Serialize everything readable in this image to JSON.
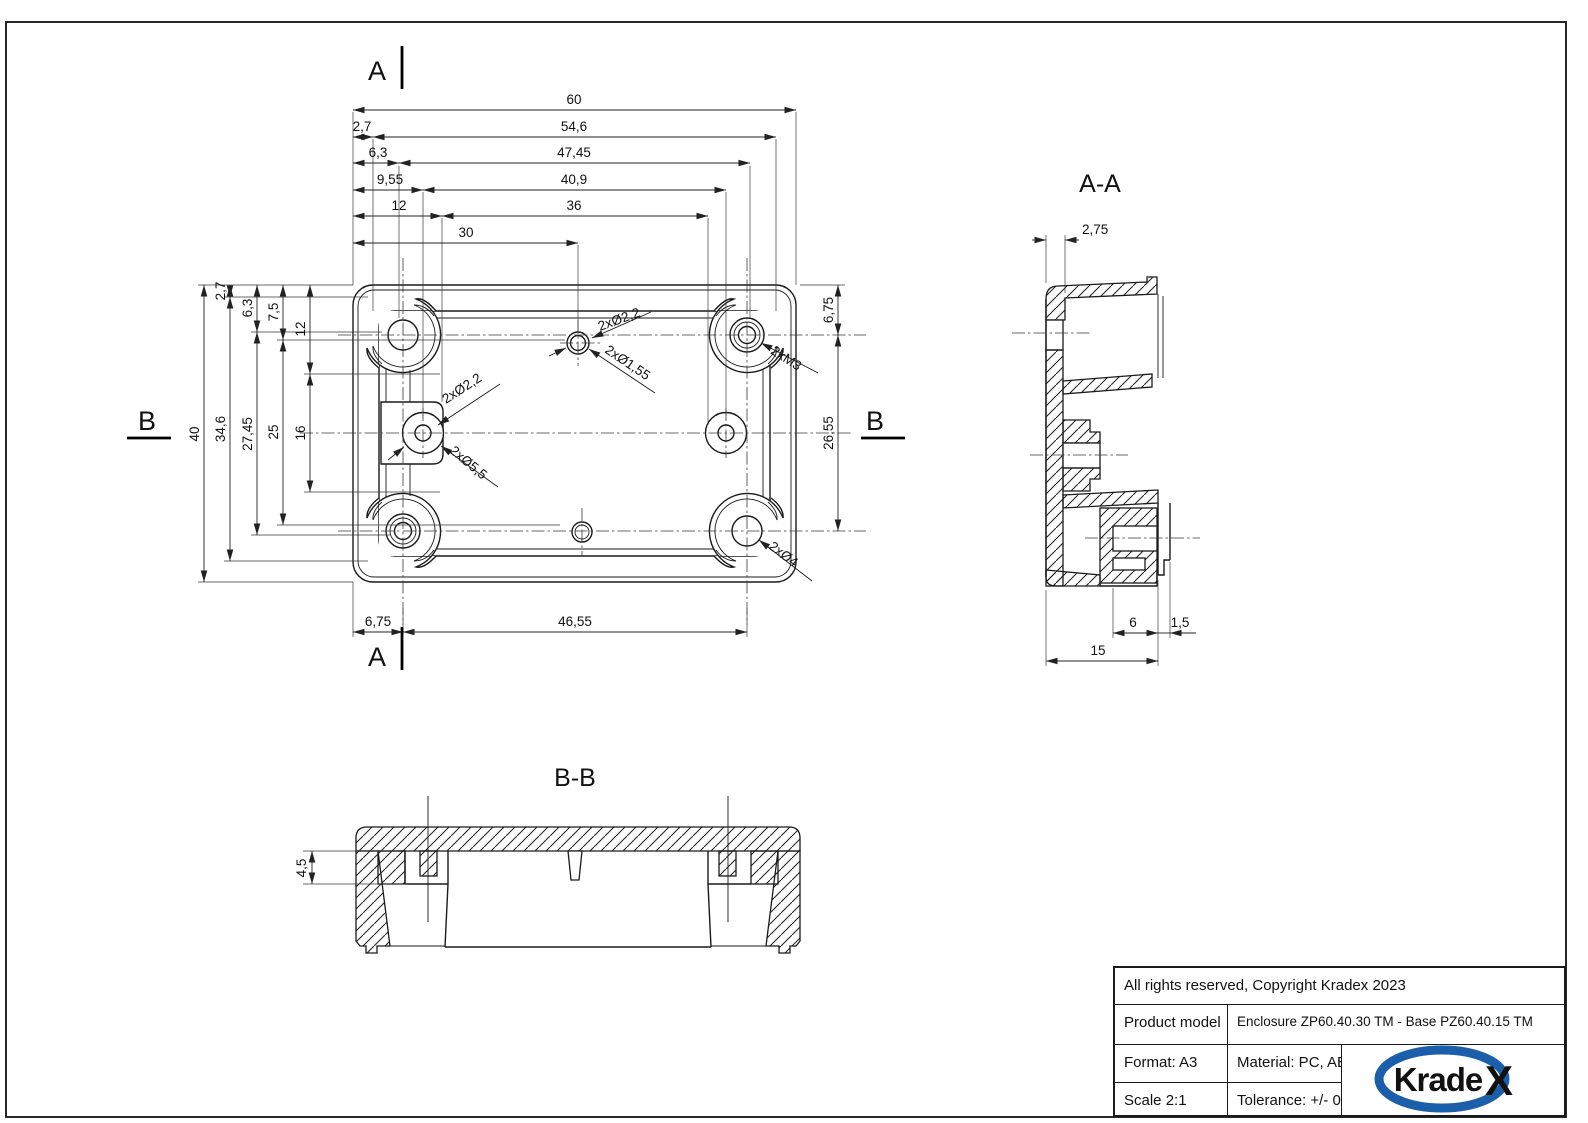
{
  "colors": {
    "line": "#1a1a1a",
    "logo_blue": "#1b5ea9"
  },
  "markers": {
    "a": "A",
    "b": "B"
  },
  "top_view": {
    "dim_60": "60",
    "dim_2_7_top": "2,7",
    "dim_54_6": "54,6",
    "dim_6_3_top": "6,3",
    "dim_47_45": "47,45",
    "dim_9_55": "9,55",
    "dim_40_9": "40,9",
    "dim_12_top": "12",
    "dim_36": "36",
    "dim_30": "30",
    "dim_40": "40",
    "dim_2_7_left": "2,7",
    "dim_34_6": "34,6",
    "dim_6_3_left": "6,3",
    "dim_27_45": "27,45",
    "dim_7_5": "7,5",
    "dim_25": "25",
    "dim_12_left": "12",
    "dim_16": "16",
    "dim_6_75_right": "6,75",
    "dim_26_55": "26,55",
    "dim_6_75_bottom": "6,75",
    "dim_46_55": "46,55",
    "ann_hole_small_outer": "2xØ2,2",
    "ann_hole_small_inner": "2xØ1,55",
    "ann_boss_hole": "2xØ2,2",
    "ann_boss_outer": "2xØ5,5",
    "ann_insert": "2xM3",
    "ann_corner_hole": "2xØ4"
  },
  "section_aa": {
    "title": "A-A",
    "dim_2_75": "2,75",
    "dim_6": "6",
    "dim_1_5": "1,5",
    "dim_15": "15"
  },
  "section_bb": {
    "title": "B-B",
    "dim_4_5": "4,5"
  },
  "title_block": {
    "copyright": "All rights reserved, Copyright Kradex 2023",
    "product_model_label": "Product model",
    "product_model_value": "Enclosure ZP60.40.30 TM - Base PZ60.40.15 TM",
    "format": "Format: A3",
    "material": "Material: PC, ABS",
    "scale": "Scale 2:1",
    "tolerance": "Tolerance: +/- 0.5",
    "logo_krade": "Krade",
    "logo_x": "X"
  }
}
